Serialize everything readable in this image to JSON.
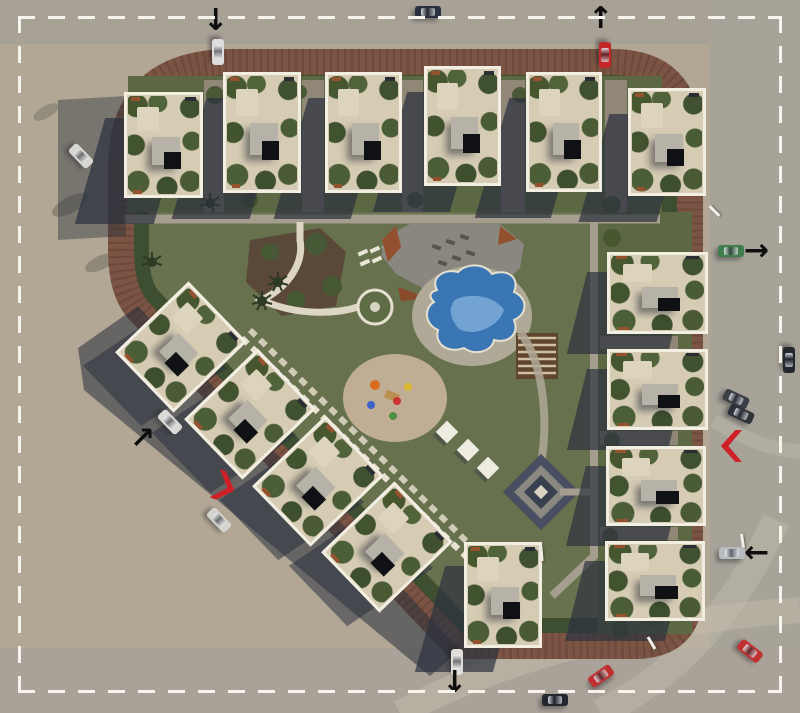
{
  "scene": {
    "name": "residential-compound-site-plan",
    "view": "top-down-aerial-render"
  },
  "palette": {
    "sand": "#b2a795",
    "asphalt": "#a8a196",
    "pavement": "#aaa298",
    "brick_road": "#7b5443",
    "hedge": "#3e4e30",
    "lawn": "#5c6843",
    "interior_green": "#68724f",
    "building_frame": "#f2eee2",
    "roof_terrace": "#d6ccb4",
    "roof_structure": "#b7b2a8",
    "shadow": "#2c323f",
    "pool_deep": "#3b76b4",
    "pool_light": "#7cabd8",
    "path": "#a59d8d",
    "stepping_path": "#e9e2d0",
    "red_marker": "#cf1f27",
    "arrow": "#0e0e0e",
    "boundary_dash": "#f6f4ed"
  },
  "boundary": {
    "style": "dashed",
    "color": "#f6f4ed"
  },
  "counts": {
    "villas_top_row": 6,
    "villas_east_column": 4,
    "villas_diagonal_row": 4,
    "villas_south": 1,
    "cars": 15,
    "entrance_arrows": 6,
    "gate_chevrons": 2
  },
  "amenities": [
    "pool-deck-plaza",
    "swimming-pool",
    "pool-apron",
    "pergola",
    "kids-playground",
    "planted-bed",
    "round-garden-feature",
    "diamond-plaza",
    "shade-structures",
    "sun-loungers",
    "palm-trees",
    "perimeter-hedge",
    "brick-ring-road"
  ],
  "buildings": {
    "groups": [
      {
        "name": "top-row",
        "rot": 0,
        "shadow": {
          "dx": -34,
          "dy": 26,
          "skew": -16,
          "opacity": 0.72
        },
        "items": [
          {
            "id": "villa-1",
            "x": 124,
            "y": 92,
            "w": 79,
            "h": 106
          },
          {
            "id": "villa-2",
            "x": 223,
            "y": 72,
            "w": 78,
            "h": 121
          },
          {
            "id": "villa-3",
            "x": 325,
            "y": 72,
            "w": 77,
            "h": 121
          },
          {
            "id": "villa-4",
            "x": 424,
            "y": 66,
            "w": 77,
            "h": 120
          },
          {
            "id": "villa-5",
            "x": 526,
            "y": 72,
            "w": 76,
            "h": 120
          },
          {
            "id": "villa-6",
            "x": 628,
            "y": 88,
            "w": 78,
            "h": 108
          }
        ]
      },
      {
        "name": "east-column",
        "rot": 0,
        "shadow": {
          "dx": -30,
          "dy": 20,
          "skew": -14,
          "opacity": 0.7
        },
        "items": [
          {
            "id": "villa-7",
            "x": 607,
            "y": 252,
            "w": 101,
            "h": 82
          },
          {
            "id": "villa-8",
            "x": 607,
            "y": 349,
            "w": 101,
            "h": 81
          },
          {
            "id": "villa-9",
            "x": 606,
            "y": 446,
            "w": 100,
            "h": 80
          },
          {
            "id": "villa-10",
            "x": 605,
            "y": 541,
            "w": 100,
            "h": 80
          }
        ]
      },
      {
        "name": "diagonal-row",
        "rot": 46,
        "shadow": {
          "dx": -26,
          "dy": 20,
          "skew": -10,
          "opacity": 0.55
        },
        "items": [
          {
            "id": "villa-11",
            "x": 139,
            "y": 296,
            "w": 84,
            "h": 102
          },
          {
            "id": "villa-12",
            "x": 208,
            "y": 363,
            "w": 84,
            "h": 102
          },
          {
            "id": "villa-13",
            "x": 276,
            "y": 430,
            "w": 84,
            "h": 102
          },
          {
            "id": "villa-14",
            "x": 345,
            "y": 496,
            "w": 84,
            "h": 102
          }
        ]
      },
      {
        "name": "south",
        "rot": 0,
        "shadow": {
          "dx": -34,
          "dy": 24,
          "skew": -16,
          "opacity": 0.7
        },
        "items": [
          {
            "id": "villa-15",
            "x": 464,
            "y": 542,
            "w": 78,
            "h": 106
          }
        ]
      }
    ]
  },
  "cars": [
    {
      "id": "car-white-north-entrance",
      "x": 218,
      "y": 52,
      "rot": 90,
      "color": "#dedede"
    },
    {
      "id": "car-dark-north-road",
      "x": 428,
      "y": 12,
      "rot": 0,
      "color": "#2a3040"
    },
    {
      "id": "car-red-northeast-exit",
      "x": 605,
      "y": 55,
      "rot": 90,
      "color": "#c62828"
    },
    {
      "id": "car-white-west-side",
      "x": 81,
      "y": 156,
      "rot": 46,
      "color": "#d8d6d0"
    },
    {
      "id": "car-green-east-exit",
      "x": 731,
      "y": 251,
      "rot": 0,
      "color": "#3f7d4b"
    },
    {
      "id": "car-black-east-edge",
      "x": 789,
      "y": 360,
      "rot": 90,
      "color": "#23272e"
    },
    {
      "id": "car-gray-east-pair-1",
      "x": 736,
      "y": 399,
      "rot": 25,
      "color": "#3a3f46"
    },
    {
      "id": "car-gray-east-pair-2",
      "x": 741,
      "y": 414,
      "rot": 25,
      "color": "#2e333a"
    },
    {
      "id": "car-silver-east-gate",
      "x": 732,
      "y": 553,
      "rot": 0,
      "color": "#b9bcbf"
    },
    {
      "id": "car-white-southwest-road-1",
      "x": 170,
      "y": 422,
      "rot": 46,
      "color": "#dbd9d3"
    },
    {
      "id": "car-white-southwest-road-2",
      "x": 219,
      "y": 520,
      "rot": 46,
      "color": "#d5d3cd"
    },
    {
      "id": "car-white-south-exit",
      "x": 457,
      "y": 662,
      "rot": 90,
      "color": "#e0ded8"
    },
    {
      "id": "car-red-south-road",
      "x": 601,
      "y": 676,
      "rot": -35,
      "color": "#c13030"
    },
    {
      "id": "car-dark-south-road",
      "x": 555,
      "y": 700,
      "rot": 0,
      "color": "#23282f"
    },
    {
      "id": "car-red-southeast-corner",
      "x": 750,
      "y": 651,
      "rot": 38,
      "color": "#c32f2f"
    }
  ],
  "markers": {
    "arrows": [
      {
        "id": "arrow-entry-north-west",
        "glyph": "↓",
        "x": 203,
        "y": 6
      },
      {
        "id": "arrow-exit-north-east",
        "glyph": "↑",
        "x": 588,
        "y": 4
      },
      {
        "id": "arrow-exit-east",
        "glyph": "→",
        "x": 744,
        "y": 236
      },
      {
        "id": "arrow-entry-east",
        "glyph": "←",
        "x": 744,
        "y": 538
      },
      {
        "id": "arrow-entry-west",
        "glyph": "↗",
        "x": 130,
        "y": 424
      },
      {
        "id": "arrow-exit-south",
        "glyph": "↓",
        "x": 442,
        "y": 668
      }
    ],
    "chevrons": [
      {
        "id": "gate-chevron-east",
        "x": 720,
        "y": 430,
        "w": 22,
        "h": 32,
        "rot": 0
      },
      {
        "id": "gate-chevron-southwest",
        "x": 214,
        "y": 472,
        "w": 22,
        "h": 30,
        "rot": 200
      }
    ],
    "lamps": [
      {
        "x": 713,
        "y": 204,
        "rot": -45
      },
      {
        "x": 741,
        "y": 534,
        "rot": -8
      },
      {
        "x": 540,
        "y": 547,
        "rot": -5
      },
      {
        "x": 650,
        "y": 636,
        "rot": -30
      }
    ]
  }
}
